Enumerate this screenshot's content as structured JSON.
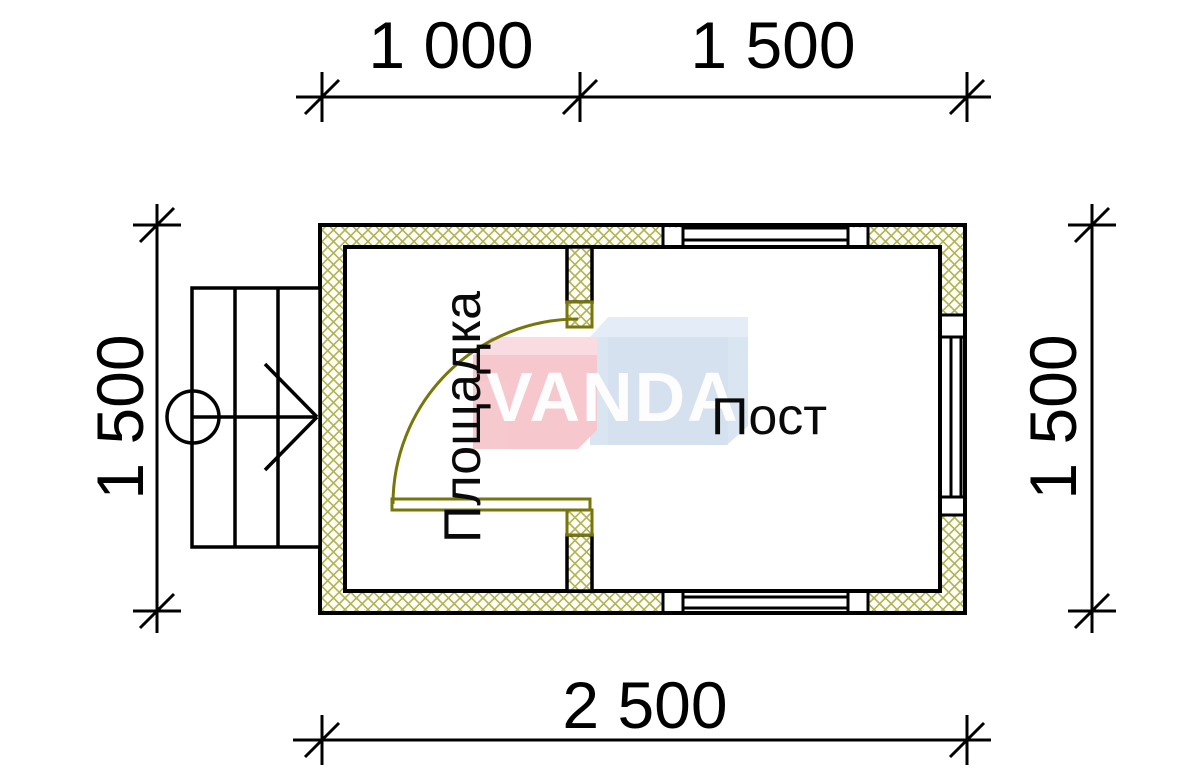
{
  "drawing_title": "Guard post floor plan",
  "dimensions": {
    "top": [
      {
        "label": "1 000"
      },
      {
        "label": "1 500"
      }
    ],
    "left": "1 500",
    "right": "1 500",
    "bottom": "2 500"
  },
  "rooms": [
    {
      "name": "Площадка"
    },
    {
      "name": "Пост"
    }
  ],
  "watermark": {
    "text": "VANDA",
    "pink": "#f6c6cb",
    "blue": "#d7e4f1",
    "text_color": "#fdfdfd"
  },
  "colors": {
    "line": "#000000",
    "wall_hatch": "#b2b257",
    "door": "#76760a"
  }
}
